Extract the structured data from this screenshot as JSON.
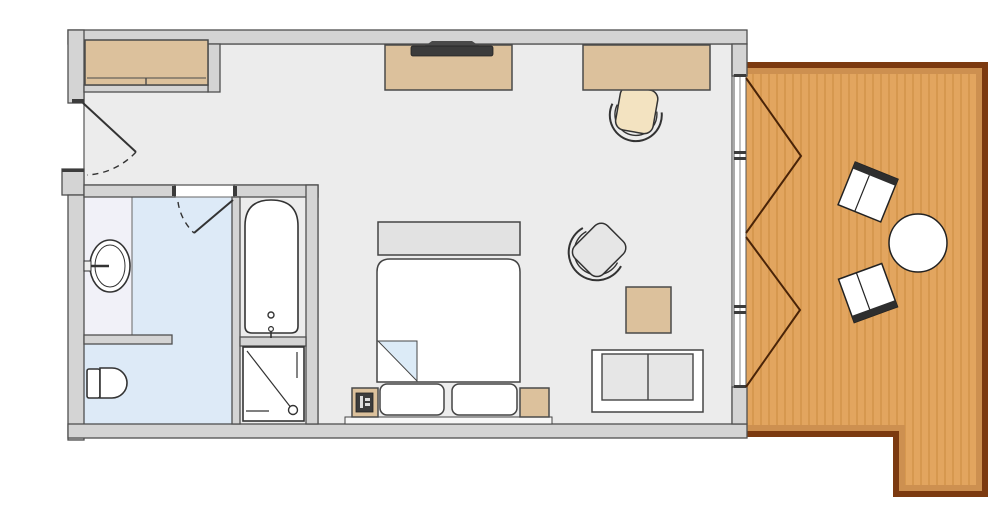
{
  "title": "Hotel room floor plan",
  "colors": {
    "wall": "#d4d4d4",
    "wall-stroke": "#4f4f4f",
    "floor": "#ececec",
    "bath-blue": "#ddeaf7",
    "alcove": "#f1f1f8",
    "tan": "#dcc19c",
    "wood": "#e2a55f",
    "wood-grain": "#d6984f",
    "wood-border": "#7c3a10",
    "wood-shadow": "#cd9050",
    "line": "#333333",
    "dark": "#3c3c3c",
    "cushion-gray": "#e6e6e6",
    "cushion-cream": "#f3e3c1",
    "fold-blue": "#dcebf7",
    "bench-gray": "#e2e2e2",
    "white": "#ffffff",
    "door-line": "#4a2408"
  },
  "rooms": [
    {
      "id": "main-room",
      "kind": "bedroom-living"
    },
    {
      "id": "bathroom",
      "kind": "bathroom"
    },
    {
      "id": "balcony",
      "kind": "wood-deck-terrace"
    }
  ],
  "furniture": [
    "wardrobe",
    "entry-door",
    "tv-console",
    "tv",
    "desk",
    "desk-chair",
    "bed",
    "foot-bench",
    "duvet-fold",
    "pillow-left",
    "pillow-right",
    "nightstand-left",
    "nightstand-lamp",
    "nightstand-right",
    "headboard",
    "armchair",
    "side-table",
    "sofa",
    "sink",
    "toilet",
    "bathtub",
    "shower",
    "bathroom-door",
    "french-doors",
    "balcony-chair-upper",
    "balcony-chair-lower",
    "balcony-round-table"
  ]
}
